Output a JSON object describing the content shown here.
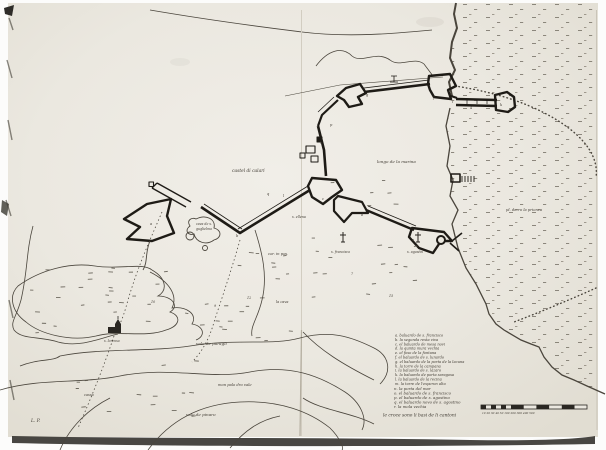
{
  "photo": {
    "description": "hand-drawn fortification map of a coastal city (calari), ink on paper scan",
    "paper_color": "#ebe8e0",
    "ink_color": "#1e1b16",
    "thin_line_color": "#4a453c",
    "text_color": "#3f3a32"
  },
  "map_labels": {
    "castel_di_calari": "castel di calari",
    "longo_marina": "longo de la marina",
    "prionca": "pl. dorro la prionca",
    "cor_in_pos": "cor. in pos.",
    "s_francisco": "s. francisco",
    "s_agostin": "s. agostin",
    "s_ellena": "s. ellena",
    "cava_line1": "cava de s.",
    "cava_line2": "guglielmo",
    "la_cava": "la cava",
    "vale_paragli": "vale de paragli",
    "mon_palo": "mon palo dro vale",
    "vale_pinaro": "vale de pinaro",
    "cassa": "cassa",
    "s_lorenso": "s. lorenso",
    "corner_initials": "L. P."
  },
  "marks": [
    "a",
    "b",
    "c",
    "d",
    "e",
    "f",
    "g",
    "h",
    "i",
    "k",
    "l",
    "p",
    "q"
  ],
  "figures": [
    "12",
    "10",
    "7",
    "15",
    "9",
    "4"
  ],
  "legend": {
    "items": [
      "a. baluardo de s. francisco",
      "b. la segonda resta viva",
      "c. el baluardo de mesa novi",
      "d. la quinta mura vechia",
      "e. el foso de la fontana",
      "f. el baluardo de s. lunardo",
      "g. el baluardo de la porta de la lacuna",
      "h. la torre de la campana",
      "i. la baluardo de s. lazaro",
      "k. la baluardo de porta saragosa",
      "l. la baluardo de la recina",
      "m. la torre de l'esperon alto",
      "n. la porta del mar",
      "o. el baluardo de s. francisco",
      "p. el baluardo de s. agostino",
      "q. el baluardo novo de s. agostino",
      "r. la mola vechia"
    ],
    "note": "le croce sono li basi de li cantoni"
  },
  "scalebar": {
    "ticks_label": "10  20  30  40  50      100        200        300        400        500"
  },
  "icons": {
    "cross_francisco": "calvary-cross",
    "cross_agostin": "calvary-cross",
    "church": "church-building",
    "gallows": "gallows-mark"
  }
}
